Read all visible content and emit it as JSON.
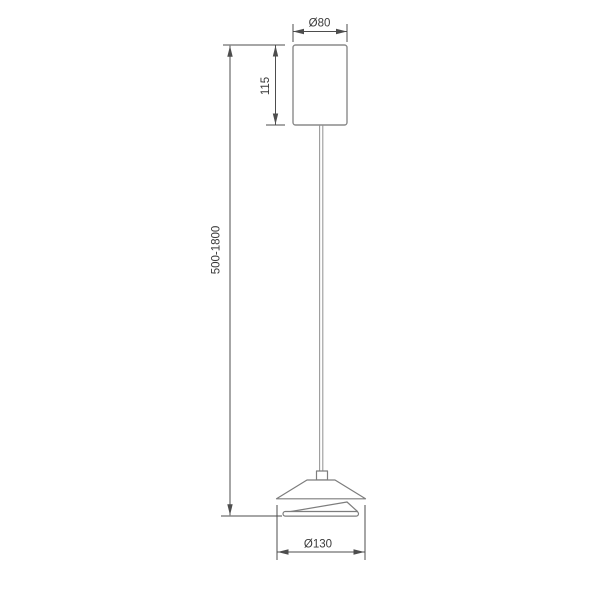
{
  "drawing": {
    "type": "pendant-lamp-technical-dimension-drawing",
    "background_color": "#ffffff",
    "colors": {
      "object_line": "#8a8a8a",
      "detail_line": "#7d7d7d",
      "dimension_line": "#4d4d4d",
      "dimension_text": "#3a3a3a"
    },
    "parts": {
      "canopy": "ceiling canopy cylinder",
      "cable": "suspension cable",
      "connector": "cable holder",
      "outer_shade": "outer cone shade",
      "inner_diffuser": "inner diffuser disc"
    },
    "dimensions": {
      "canopy_diameter": "Ø80",
      "canopy_height": "115",
      "drop_height_range": "500-1800",
      "shade_diameter": "Ø130"
    }
  }
}
